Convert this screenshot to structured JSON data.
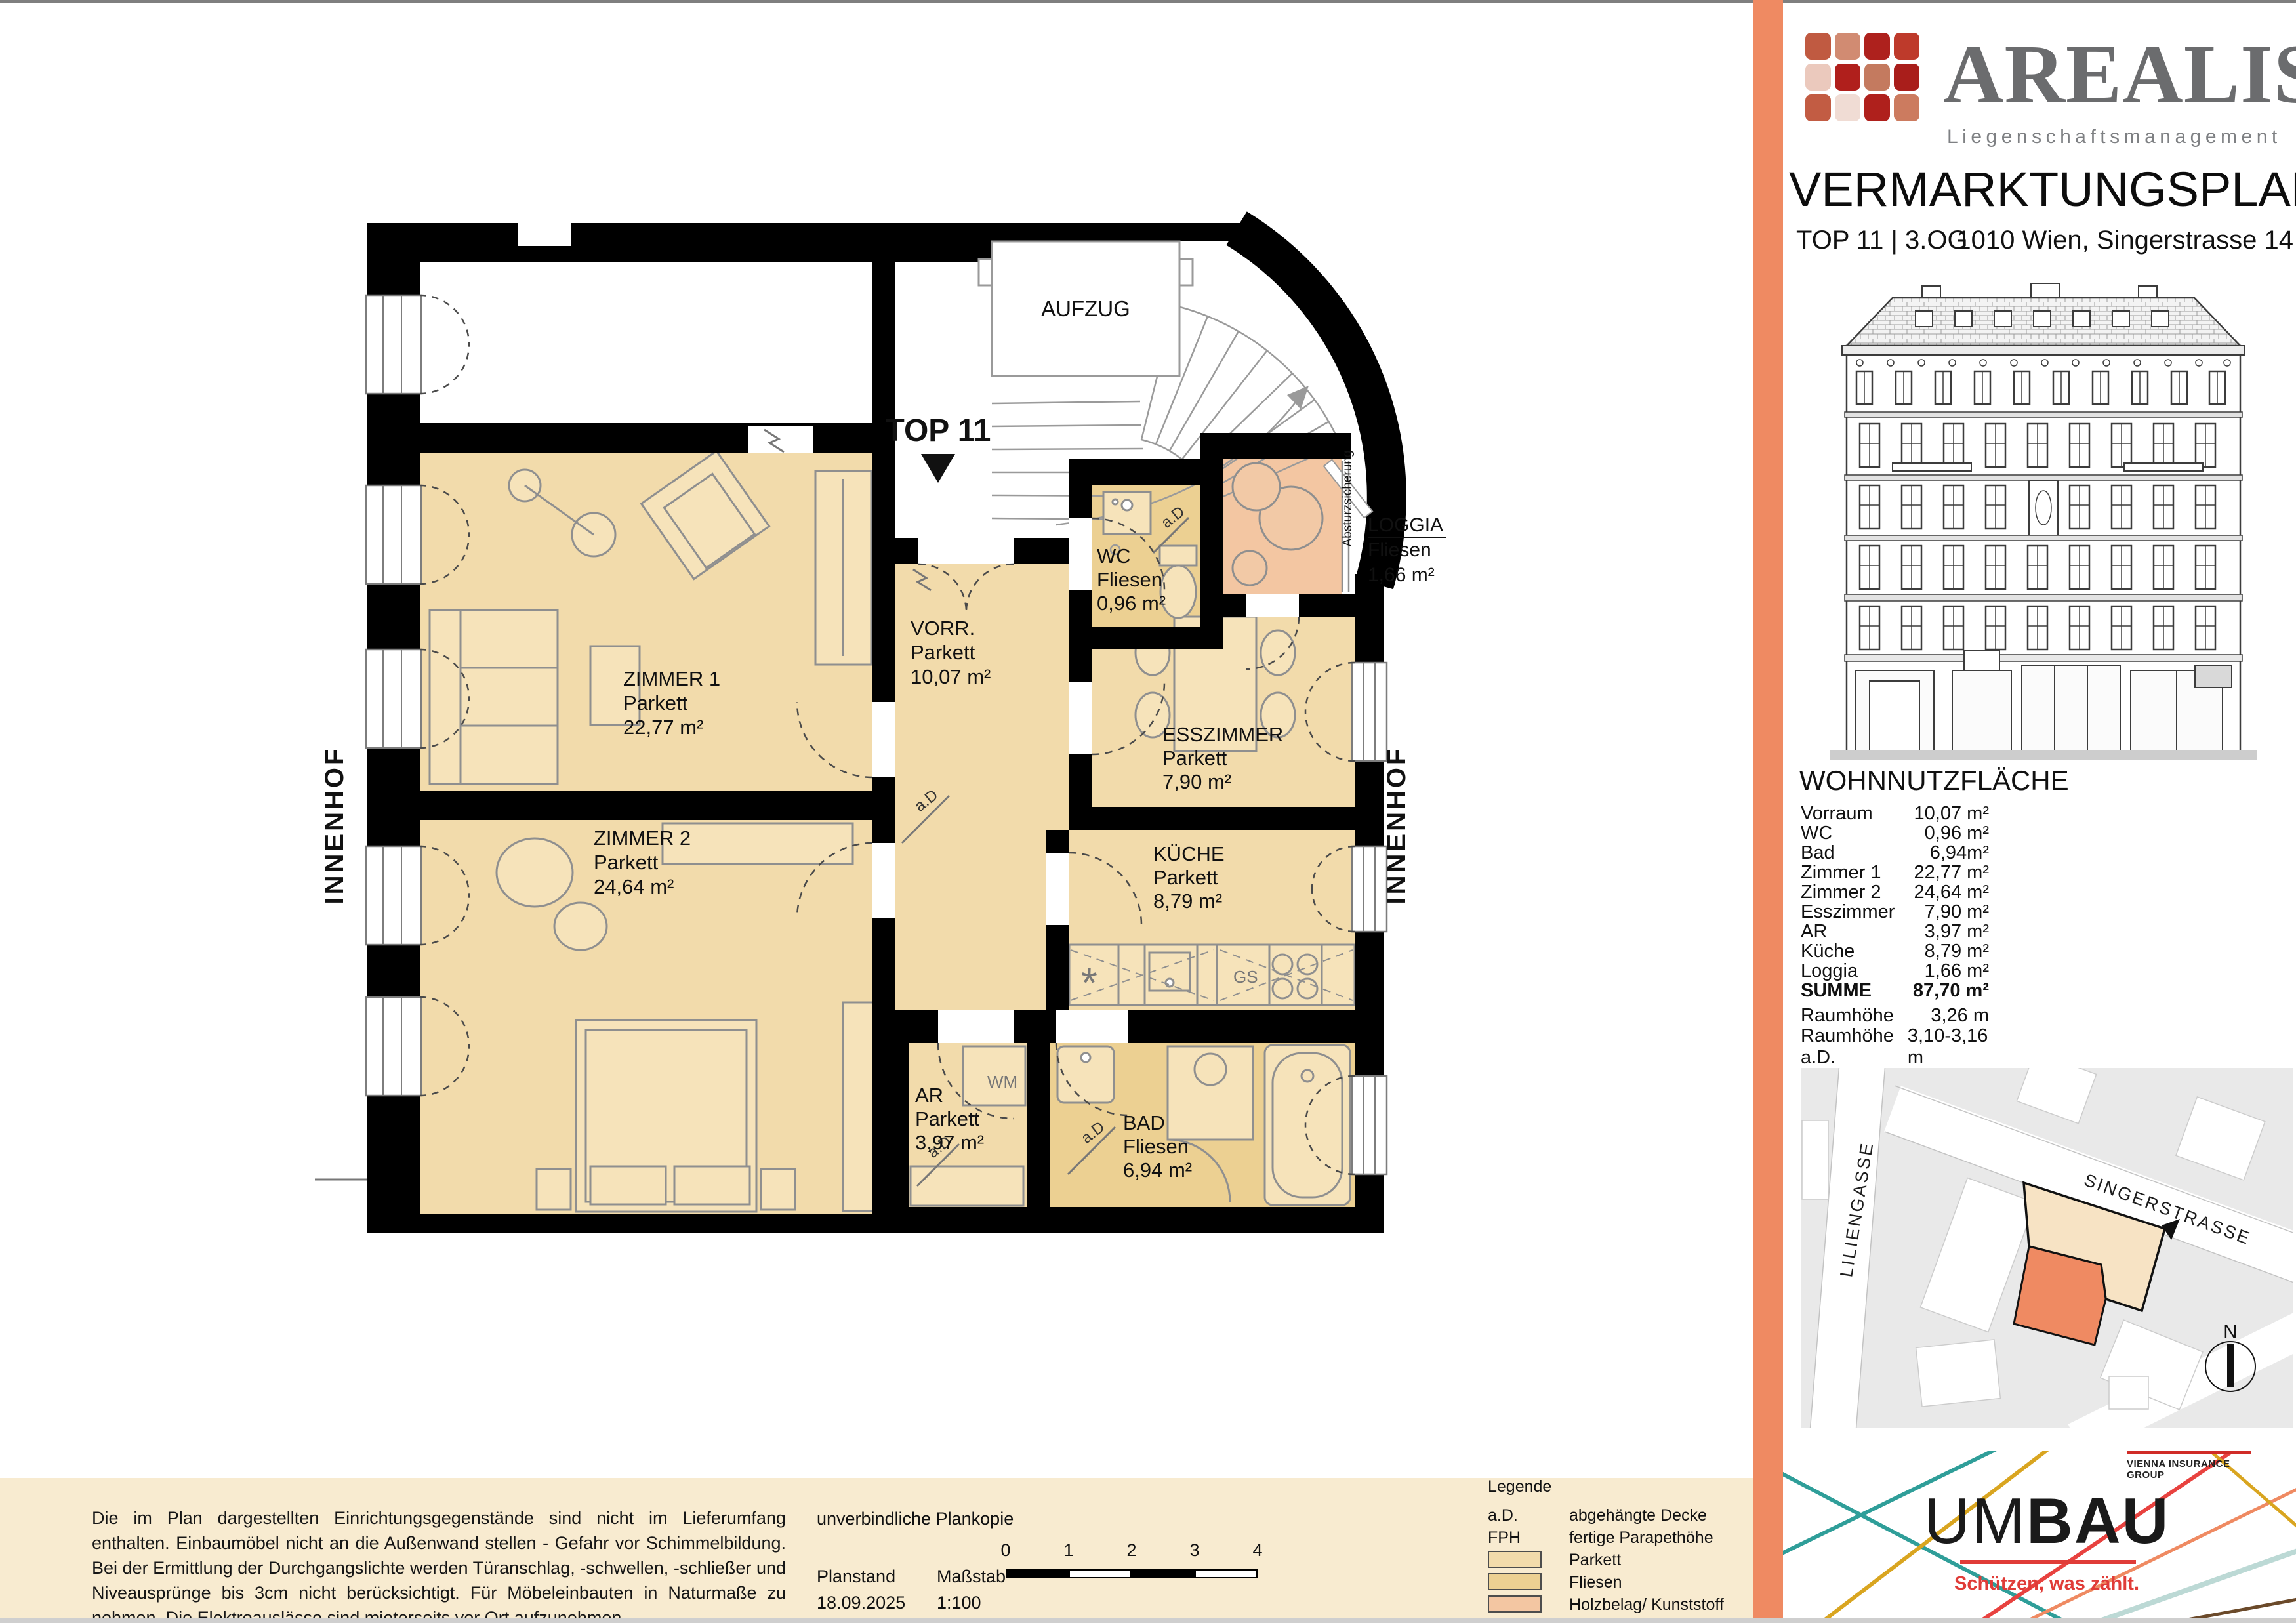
{
  "plan": {
    "top_label": "TOP 11",
    "aufzug": "AUFZUG",
    "innenhof_left": "INNENHOF",
    "innenhof_right": "INNENHOF",
    "absturzsicherung": "Absturzsicherung",
    "rooms": {
      "zimmer1": {
        "name": "ZIMMER 1",
        "floor": "Parkett",
        "area": "22,77 m²"
      },
      "zimmer2": {
        "name": "ZIMMER 2",
        "floor": "Parkett",
        "area": "24,64 m²"
      },
      "vorraum": {
        "name": "VORR.",
        "floor": "Parkett",
        "area": "10,07 m²"
      },
      "wc": {
        "name": "WC",
        "floor": "Fliesen",
        "area": "0,96 m²"
      },
      "esszimmer": {
        "name": "ESSZIMMER",
        "floor": "Parkett",
        "area": "7,90 m²"
      },
      "kueche": {
        "name": "KÜCHE",
        "floor": "Parkett",
        "area": "8,79 m²"
      },
      "ar": {
        "name": "AR",
        "floor": "Parkett",
        "area": "3,97 m²"
      },
      "bad": {
        "name": "BAD",
        "floor": "Fliesen",
        "area": "6,94 m²"
      },
      "loggia": {
        "name": "LOGGIA",
        "floor": "Fliesen",
        "area": "1,66 m²"
      }
    },
    "annotations": {
      "ad": "a.D",
      "wm": "WM",
      "gs": "GS",
      "fridge": "*"
    }
  },
  "panel": {
    "brand": {
      "name": "AREALIS",
      "subtitle": "Liegenschaftsmanagement",
      "logo_colors": [
        "#C05A41",
        "#D18B72",
        "#AE211D",
        "#BE3A2B",
        "#EBC9BD",
        "#B01F1C",
        "#C47A5F",
        "#A91E1B",
        "#C25C43",
        "#F0DCD4",
        "#AF201C",
        "#CC7B5F"
      ]
    },
    "title": "VERMARKTUNGSPLAN",
    "unit": "TOP 11 | 3.OG",
    "address": "1010 Wien, Singerstrasse 14",
    "area_table": {
      "title": "WOHNNUTZFLÄCHE",
      "rows": [
        {
          "label": "Vorraum",
          "value": "10,07 m²"
        },
        {
          "label": "WC",
          "value": "0,96 m²"
        },
        {
          "label": "Bad",
          "value": "6,94m²"
        },
        {
          "label": "Zimmer 1",
          "value": "22,77 m²"
        },
        {
          "label": "Zimmer 2",
          "value": "24,64 m²"
        },
        {
          "label": "Esszimmer",
          "value": "7,90 m²"
        },
        {
          "label": "AR",
          "value": "3,97 m²"
        },
        {
          "label": "Küche",
          "value": "8,79 m²"
        },
        {
          "label": "Loggia",
          "value": "1,66 m²"
        }
      ],
      "summe": {
        "label": "SUMME",
        "value": "87,70 m²"
      },
      "heights": [
        {
          "label": "Raumhöhe",
          "value": "3,26 m"
        },
        {
          "label": "Raumhöhe a.D.",
          "value": "3,10-3,16 m"
        }
      ]
    },
    "map": {
      "street1": "SINGERSTRASSE",
      "street2": "LILIENGASSE",
      "compass": "N"
    },
    "umbau": {
      "um": "UM",
      "bau": "BAU",
      "tagline": "Schützen, was zählt.",
      "vig": "VIENNA INSURANCE GROUP"
    }
  },
  "footer": {
    "disclaimer": "Die im Plan dargestellten Einrichtungsgegenstände sind nicht im Lieferumfang enthalten. Einbaumöbel nicht an die Außenwand stellen - Gefahr vor Schimmelbildung. Bei der Ermittlung der Durchgangslichte werden Türanschlag, -schwellen, -schließer und Niveausprünge bis 3cm nicht berücksichtigt. Für Möbeleinbauten in Naturmaße zu nehmen. Die Elektroauslässe sind mieterseits vor Ort aufzunehmen.",
    "plankopie": "unverbindliche Plankopie",
    "planstand_label": "Planstand",
    "planstand_value": "18.09.2025",
    "massstab_label": "Maßstab",
    "massstab_value": "1:100",
    "scale_ticks": [
      "0",
      "1",
      "2",
      "3",
      "4"
    ],
    "legend": {
      "title": "Legende",
      "rows": [
        {
          "key": "a.D.",
          "label": "abgehängte Decke"
        },
        {
          "key": "FPH",
          "label": "fertige Parapethöhe"
        }
      ],
      "swatches": [
        {
          "label": "Parkett"
        },
        {
          "label": "Fliesen"
        },
        {
          "label": "Holzbelag/ Kunststoff"
        }
      ]
    }
  },
  "colors": {
    "parkett": "#F2DBAB",
    "fliesen": "#ECD092",
    "holzbelag": "#F3C6A2",
    "divider_band": "#EF8A62",
    "footer_bg": "#F8EBD0",
    "wall": "#000000",
    "map_highlight_orange": "#EF8A62",
    "map_highlight_cream": "#F7E3C4",
    "umbau_red": "#E03C38"
  }
}
